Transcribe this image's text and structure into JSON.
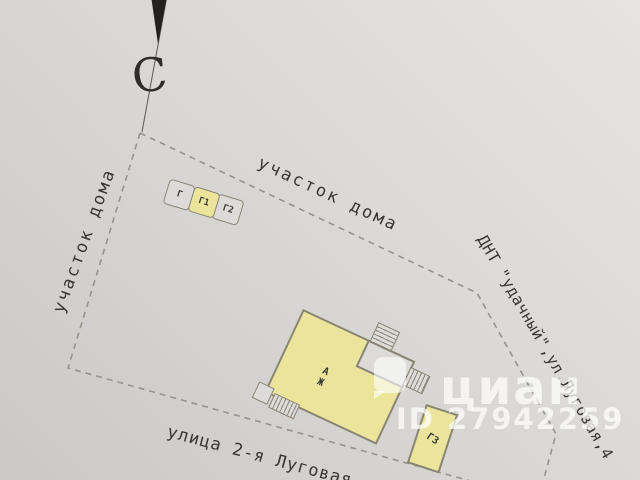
{
  "compass": {
    "north_label": "С"
  },
  "labels": {
    "plot_top": "участок дома",
    "plot_left": "участок дома",
    "territory": "ДНТ \"удачный\",ул.Луговая,4",
    "street": "улица 2-я Луговая"
  },
  "buildings": {
    "shed": {
      "cells": [
        "Г",
        "Г1",
        "Г2"
      ]
    },
    "house": {
      "line1": "А",
      "line2": "Ж"
    },
    "garage": {
      "label": "Г3"
    }
  },
  "watermark": {
    "brand": "циан",
    "listing_id": "ID 27942259"
  },
  "colors": {
    "paper": "#d9d7d3",
    "building_fill": "#ebe59c",
    "outline": "#8a8477",
    "boundary_dash": "#97938b",
    "ink": "#393733",
    "watermark": "rgba(255,255,255,0.72)"
  }
}
